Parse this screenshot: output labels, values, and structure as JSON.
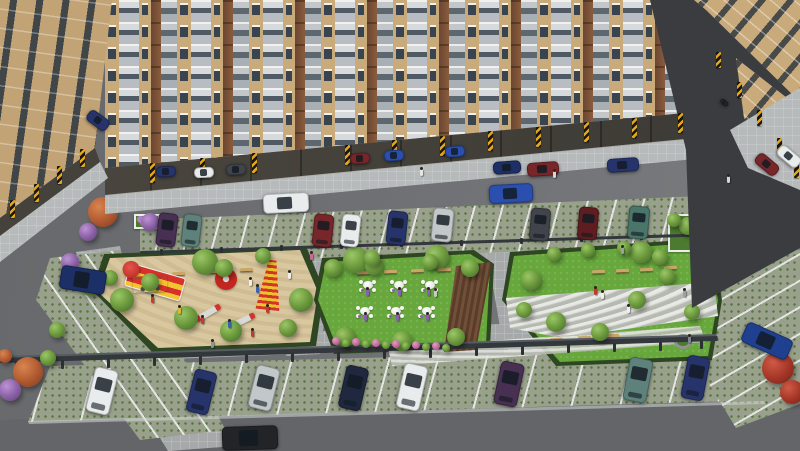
{
  "scene": {
    "description": "Aerial 3D architectural rendering of a residential apartment complex: tan mid-rise towers with balconies and stilt parking, internal road with moving cars, two rows of grass-paver parking bays, a sand playground with red-and-yellow play equipment, a central event lawn with six white table-and-chair sets, a pebble-path garden with benches, landscaped trees and flower planters.",
    "canvas": {
      "w": 800,
      "h": 451
    },
    "colors": {
      "road": "#6e7073",
      "roadBottom": "#636568",
      "shadow": "#3a3c40",
      "paver": "#a6a9aa",
      "apron": "#b7babb",
      "grassPaver": "#99a08c",
      "grassDot": "#5b7744",
      "lawn": "#67a73c",
      "sand": "#d9c79f",
      "hedge": "#2e4722",
      "line": "#e3e5e3",
      "rail": "#33383c",
      "tan": "#c8aa7b",
      "brown": "#7b5237",
      "glass": "#39444f",
      "stilt": "#45423c",
      "hazardY": "#e2a61d",
      "pebble": "#ccCfc6",
      "deck": "#5a3c28",
      "bench": "#c9a76a",
      "tableWhite": "#f4f4f2",
      "white": "#e9ecec",
      "silver": "#c2c7c9",
      "navy": "#27346b",
      "navy2": "#1c2f66",
      "blue": "#2a4faf",
      "blue2": "#1f3f8f",
      "darkblue": "#20283f",
      "darkred": "#77262a",
      "maroon": "#5f1d22",
      "purple": "#473052",
      "teal": "#5e827b",
      "tealgreen": "#49756a",
      "darkgrey": "#41454b",
      "grey": "#888d91",
      "black": "#222428"
    },
    "facade_pattern": {
      "start_x": 105,
      "repeat": 8,
      "unit": [
        {
          "t": "wall",
          "w": 14
        },
        {
          "t": "balc",
          "w": 20
        },
        {
          "t": "wall",
          "w": 12
        },
        {
          "t": "brown",
          "w": 10
        },
        {
          "t": "gbal",
          "w": 16
        }
      ],
      "tail": [
        {
          "t": "wall",
          "w": 14
        }
      ]
    },
    "cars": [
      {
        "x": 157,
        "y": 213,
        "w": 20,
        "h": 34,
        "r": 7,
        "c": "purple"
      },
      {
        "x": 182,
        "y": 214,
        "w": 19,
        "h": 33,
        "r": 7,
        "c": "teal"
      },
      {
        "x": 313,
        "y": 214,
        "w": 20,
        "h": 33,
        "r": 6,
        "c": "darkred"
      },
      {
        "x": 341,
        "y": 214,
        "w": 19,
        "h": 33,
        "r": 6,
        "c": "white"
      },
      {
        "x": 387,
        "y": 211,
        "w": 20,
        "h": 34,
        "r": 6,
        "c": "navy"
      },
      {
        "x": 432,
        "y": 208,
        "w": 21,
        "h": 34,
        "r": 6,
        "c": "silver"
      },
      {
        "x": 530,
        "y": 208,
        "w": 20,
        "h": 33,
        "r": 5,
        "c": "darkgrey"
      },
      {
        "x": 578,
        "y": 207,
        "w": 20,
        "h": 33,
        "r": 5,
        "c": "maroon"
      },
      {
        "x": 628,
        "y": 206,
        "w": 21,
        "h": 33,
        "r": 5,
        "c": "tealgreen"
      },
      {
        "x": 90,
        "y": 368,
        "w": 24,
        "h": 46,
        "r": 14,
        "c": "white"
      },
      {
        "x": 190,
        "y": 370,
        "w": 23,
        "h": 44,
        "r": 14,
        "c": "navy"
      },
      {
        "x": 252,
        "y": 366,
        "w": 24,
        "h": 44,
        "r": 14,
        "c": "silver"
      },
      {
        "x": 342,
        "y": 366,
        "w": 23,
        "h": 44,
        "r": 13,
        "c": "darkblue"
      },
      {
        "x": 400,
        "y": 364,
        "w": 24,
        "h": 46,
        "r": 13,
        "c": "white"
      },
      {
        "x": 497,
        "y": 362,
        "w": 24,
        "h": 44,
        "r": 12,
        "c": "purple"
      },
      {
        "x": 626,
        "y": 358,
        "w": 24,
        "h": 44,
        "r": 11,
        "c": "teal"
      },
      {
        "x": 684,
        "y": 356,
        "w": 23,
        "h": 44,
        "r": 11,
        "c": "navy"
      },
      {
        "x": 263,
        "y": 193,
        "w": 46,
        "h": 20,
        "r": -3,
        "c": "white"
      },
      {
        "x": 489,
        "y": 184,
        "w": 44,
        "h": 19,
        "r": -3,
        "c": "blue"
      },
      {
        "x": 527,
        "y": 162,
        "w": 32,
        "h": 14,
        "r": -4,
        "c": "darkred"
      },
      {
        "x": 607,
        "y": 158,
        "w": 32,
        "h": 14,
        "r": -4,
        "c": "navy"
      },
      {
        "x": 493,
        "y": 161,
        "w": 28,
        "h": 13,
        "r": -4,
        "c": "navy2"
      },
      {
        "x": 156,
        "y": 166,
        "w": 20,
        "h": 11,
        "r": -3,
        "c": "navy"
      },
      {
        "x": 194,
        "y": 167,
        "w": 20,
        "h": 11,
        "r": -3,
        "c": "white"
      },
      {
        "x": 226,
        "y": 164,
        "w": 20,
        "h": 11,
        "r": -3,
        "c": "darkgrey"
      },
      {
        "x": 350,
        "y": 153,
        "w": 20,
        "h": 11,
        "r": -4,
        "c": "darkred"
      },
      {
        "x": 384,
        "y": 150,
        "w": 20,
        "h": 11,
        "r": -4,
        "c": "blue"
      },
      {
        "x": 445,
        "y": 146,
        "w": 20,
        "h": 11,
        "r": -4,
        "c": "blue"
      },
      {
        "x": 754,
        "y": 158,
        "w": 26,
        "h": 13,
        "r": 40,
        "c": "darkred"
      },
      {
        "x": 776,
        "y": 150,
        "w": 26,
        "h": 13,
        "r": 40,
        "c": "white"
      },
      {
        "x": 86,
        "y": 114,
        "w": 24,
        "h": 13,
        "r": 36,
        "c": "navy"
      },
      {
        "x": 60,
        "y": 268,
        "w": 46,
        "h": 24,
        "r": 9,
        "c": "navy2"
      },
      {
        "x": 742,
        "y": 330,
        "w": 50,
        "h": 22,
        "r": 24,
        "c": "blue2"
      },
      {
        "x": 222,
        "y": 426,
        "w": 56,
        "h": 24,
        "r": -2,
        "c": "black"
      },
      {
        "x": 720,
        "y": 100,
        "w": 9,
        "h": 5,
        "r": 40,
        "c": "black"
      }
    ],
    "hazards": [
      {
        "x": 150,
        "y": 163,
        "h": 20
      },
      {
        "x": 200,
        "y": 158,
        "h": 20
      },
      {
        "x": 252,
        "y": 153,
        "h": 20
      },
      {
        "x": 345,
        "y": 145,
        "h": 20
      },
      {
        "x": 392,
        "y": 140,
        "h": 20
      },
      {
        "x": 440,
        "y": 136,
        "h": 20
      },
      {
        "x": 488,
        "y": 131,
        "h": 20
      },
      {
        "x": 536,
        "y": 127,
        "h": 20
      },
      {
        "x": 584,
        "y": 122,
        "h": 20
      },
      {
        "x": 632,
        "y": 118,
        "h": 20
      },
      {
        "x": 678,
        "y": 113,
        "h": 20
      },
      {
        "x": 10,
        "y": 200,
        "h": 18
      },
      {
        "x": 34,
        "y": 184,
        "h": 18
      },
      {
        "x": 57,
        "y": 166,
        "h": 18
      },
      {
        "x": 80,
        "y": 149,
        "h": 18
      },
      {
        "x": 716,
        "y": 52,
        "h": 16
      },
      {
        "x": 737,
        "y": 82,
        "h": 16
      },
      {
        "x": 757,
        "y": 110,
        "h": 16
      },
      {
        "x": 777,
        "y": 138,
        "h": 16
      },
      {
        "x": 794,
        "y": 162,
        "h": 16
      }
    ],
    "trees": [
      {
        "x": 205,
        "y": 262,
        "r": 13,
        "t": "g"
      },
      {
        "x": 224,
        "y": 268,
        "r": 9,
        "t": "g"
      },
      {
        "x": 356,
        "y": 260,
        "r": 13,
        "t": "g"
      },
      {
        "x": 374,
        "y": 266,
        "r": 9,
        "t": "g"
      },
      {
        "x": 437,
        "y": 257,
        "r": 12,
        "t": "g"
      },
      {
        "x": 641,
        "y": 252,
        "r": 11,
        "t": "g"
      },
      {
        "x": 660,
        "y": 257,
        "r": 8,
        "t": "g"
      },
      {
        "x": 688,
        "y": 226,
        "r": 9,
        "t": "g"
      },
      {
        "x": 706,
        "y": 232,
        "r": 8,
        "t": "g"
      },
      {
        "x": 674,
        "y": 220,
        "r": 7,
        "t": "g"
      },
      {
        "x": 712,
        "y": 222,
        "r": 15,
        "t": "r"
      },
      {
        "x": 700,
        "y": 242,
        "r": 8,
        "t": "p"
      },
      {
        "x": 122,
        "y": 300,
        "r": 12,
        "t": "g"
      },
      {
        "x": 150,
        "y": 282,
        "r": 9,
        "t": "g"
      },
      {
        "x": 186,
        "y": 318,
        "r": 12,
        "t": "g"
      },
      {
        "x": 231,
        "y": 331,
        "r": 11,
        "t": "g"
      },
      {
        "x": 301,
        "y": 300,
        "r": 12,
        "t": "g"
      },
      {
        "x": 288,
        "y": 328,
        "r": 9,
        "t": "g"
      },
      {
        "x": 263,
        "y": 256,
        "r": 8,
        "t": "g"
      },
      {
        "x": 110,
        "y": 278,
        "r": 8,
        "t": "g"
      },
      {
        "x": 333,
        "y": 268,
        "r": 9,
        "t": "g"
      },
      {
        "x": 345,
        "y": 337,
        "r": 10,
        "t": "g"
      },
      {
        "x": 402,
        "y": 341,
        "r": 10,
        "t": "g"
      },
      {
        "x": 456,
        "y": 337,
        "r": 9,
        "t": "g"
      },
      {
        "x": 470,
        "y": 268,
        "r": 9,
        "t": "g"
      },
      {
        "x": 430,
        "y": 262,
        "r": 8,
        "t": "g"
      },
      {
        "x": 372,
        "y": 258,
        "r": 8,
        "t": "g"
      },
      {
        "x": 336,
        "y": 341,
        "r": 4,
        "t": "pk"
      },
      {
        "x": 346,
        "y": 343,
        "r": 4,
        "t": "g"
      },
      {
        "x": 356,
        "y": 342,
        "r": 4,
        "t": "pk"
      },
      {
        "x": 366,
        "y": 344,
        "r": 4,
        "t": "g"
      },
      {
        "x": 376,
        "y": 343,
        "r": 4,
        "t": "pk"
      },
      {
        "x": 386,
        "y": 345,
        "r": 4,
        "t": "g"
      },
      {
        "x": 396,
        "y": 344,
        "r": 4,
        "t": "pk"
      },
      {
        "x": 406,
        "y": 346,
        "r": 4,
        "t": "g"
      },
      {
        "x": 416,
        "y": 345,
        "r": 4,
        "t": "pk"
      },
      {
        "x": 426,
        "y": 347,
        "r": 4,
        "t": "g"
      },
      {
        "x": 436,
        "y": 346,
        "r": 4,
        "t": "pk"
      },
      {
        "x": 446,
        "y": 348,
        "r": 4,
        "t": "g"
      },
      {
        "x": 531,
        "y": 280,
        "r": 10,
        "t": "g"
      },
      {
        "x": 524,
        "y": 310,
        "r": 8,
        "t": "g"
      },
      {
        "x": 556,
        "y": 322,
        "r": 10,
        "t": "g"
      },
      {
        "x": 600,
        "y": 332,
        "r": 9,
        "t": "g"
      },
      {
        "x": 637,
        "y": 300,
        "r": 9,
        "t": "g"
      },
      {
        "x": 667,
        "y": 276,
        "r": 8,
        "t": "g"
      },
      {
        "x": 692,
        "y": 312,
        "r": 8,
        "t": "g"
      },
      {
        "x": 710,
        "y": 288,
        "r": 8,
        "t": "g"
      },
      {
        "x": 588,
        "y": 250,
        "r": 7,
        "t": "g"
      },
      {
        "x": 624,
        "y": 248,
        "r": 7,
        "t": "g"
      },
      {
        "x": 554,
        "y": 254,
        "r": 7,
        "t": "g"
      },
      {
        "x": 103,
        "y": 212,
        "r": 15,
        "t": "o"
      },
      {
        "x": 88,
        "y": 232,
        "r": 9,
        "t": "p"
      },
      {
        "x": 150,
        "y": 222,
        "r": 9,
        "t": "p"
      },
      {
        "x": 70,
        "y": 262,
        "r": 9,
        "t": "p"
      },
      {
        "x": 90,
        "y": 287,
        "r": 9,
        "t": "g"
      },
      {
        "x": 57,
        "y": 330,
        "r": 8,
        "t": "g"
      },
      {
        "x": 28,
        "y": 372,
        "r": 15,
        "t": "o"
      },
      {
        "x": 10,
        "y": 390,
        "r": 11,
        "t": "p"
      },
      {
        "x": 48,
        "y": 358,
        "r": 8,
        "t": "g"
      },
      {
        "x": 5,
        "y": 356,
        "r": 7,
        "t": "o"
      },
      {
        "x": 778,
        "y": 368,
        "r": 16,
        "t": "r"
      },
      {
        "x": 792,
        "y": 392,
        "r": 12,
        "t": "r"
      }
    ],
    "people": [
      {
        "x": 420,
        "y": 169,
        "c": "#e6e6e3"
      },
      {
        "x": 553,
        "y": 171,
        "c": "#d9d6d0"
      },
      {
        "x": 310,
        "y": 253,
        "c": "#c76a95"
      },
      {
        "x": 249,
        "y": 279,
        "c": "#f0f0ee"
      },
      {
        "x": 256,
        "y": 286,
        "c": "#3a62b0"
      },
      {
        "x": 151,
        "y": 296,
        "c": "#c23b2e"
      },
      {
        "x": 178,
        "y": 307,
        "c": "#d8b83a"
      },
      {
        "x": 201,
        "y": 317,
        "c": "#c23b2e"
      },
      {
        "x": 228,
        "y": 321,
        "c": "#3a62b0"
      },
      {
        "x": 251,
        "y": 330,
        "c": "#c23b2e"
      },
      {
        "x": 266,
        "y": 306,
        "c": "#c23b2e"
      },
      {
        "x": 288,
        "y": 272,
        "c": "#f0f0ee"
      },
      {
        "x": 211,
        "y": 341,
        "c": "#8e959b"
      },
      {
        "x": 594,
        "y": 288,
        "c": "#c0392b"
      },
      {
        "x": 601,
        "y": 292,
        "c": "#f0f0ee"
      },
      {
        "x": 627,
        "y": 306,
        "c": "#eef0f0"
      },
      {
        "x": 683,
        "y": 290,
        "c": "#9aa2a8"
      },
      {
        "x": 621,
        "y": 247,
        "c": "#9aa2a8"
      },
      {
        "x": 688,
        "y": 336,
        "c": "#7f8890"
      },
      {
        "x": 434,
        "y": 290,
        "c": "#c9c9c9"
      },
      {
        "x": 366,
        "y": 289,
        "c": "#8a5fb0"
      },
      {
        "x": 398,
        "y": 289,
        "c": "#8a5fb0"
      },
      {
        "x": 427,
        "y": 289,
        "c": "#8a5fb0"
      },
      {
        "x": 364,
        "y": 314,
        "c": "#8a5fb0"
      },
      {
        "x": 396,
        "y": 314,
        "c": "#8a5fb0"
      },
      {
        "x": 426,
        "y": 314,
        "c": "#8a5fb0"
      },
      {
        "x": 727,
        "y": 176,
        "c": "#d9d6d0"
      }
    ],
    "tables": [
      {
        "x": 359,
        "y": 278
      },
      {
        "x": 390,
        "y": 278
      },
      {
        "x": 421,
        "y": 278
      },
      {
        "x": 356,
        "y": 304
      },
      {
        "x": 387,
        "y": 304
      },
      {
        "x": 418,
        "y": 304
      }
    ],
    "benches": [
      {
        "x": 357,
        "y": 271
      },
      {
        "x": 384,
        "y": 270
      },
      {
        "x": 411,
        "y": 269
      },
      {
        "x": 438,
        "y": 268
      },
      {
        "x": 172,
        "y": 272
      },
      {
        "x": 206,
        "y": 270
      },
      {
        "x": 240,
        "y": 268
      },
      {
        "x": 592,
        "y": 270
      },
      {
        "x": 616,
        "y": 269
      },
      {
        "x": 640,
        "y": 268
      },
      {
        "x": 664,
        "y": 266
      },
      {
        "x": 550,
        "y": 338
      },
      {
        "x": 578,
        "y": 336
      },
      {
        "x": 606,
        "y": 334
      }
    ],
    "planters": [
      {
        "x": 296,
        "y": 149,
        "w": 34,
        "h": 30,
        "t": "purple"
      },
      {
        "x": 56,
        "y": 152,
        "w": 30,
        "h": 20,
        "t": "purple"
      },
      {
        "x": 134,
        "y": 214,
        "w": 26,
        "h": 15,
        "t": "purple"
      },
      {
        "x": 744,
        "y": 147,
        "w": 48,
        "h": 24,
        "t": "hedge"
      },
      {
        "x": 668,
        "y": 214,
        "w": 64,
        "h": 38,
        "t": "hedge"
      }
    ],
    "posts": [
      {
        "x": 15,
        "y": 361,
        "h": 9
      },
      {
        "x": 61,
        "y": 360,
        "h": 9
      },
      {
        "x": 107,
        "y": 359,
        "h": 9
      },
      {
        "x": 153,
        "y": 357,
        "h": 9
      },
      {
        "x": 199,
        "y": 356,
        "h": 9
      },
      {
        "x": 245,
        "y": 354,
        "h": 9
      },
      {
        "x": 291,
        "y": 353,
        "h": 9
      },
      {
        "x": 337,
        "y": 352,
        "h": 9
      },
      {
        "x": 383,
        "y": 350,
        "h": 9
      },
      {
        "x": 429,
        "y": 349,
        "h": 9
      },
      {
        "x": 475,
        "y": 347,
        "h": 9
      },
      {
        "x": 521,
        "y": 346,
        "h": 9
      },
      {
        "x": 567,
        "y": 344,
        "h": 9
      },
      {
        "x": 613,
        "y": 343,
        "h": 9
      },
      {
        "x": 659,
        "y": 342,
        "h": 9
      },
      {
        "x": 700,
        "y": 340,
        "h": 9
      },
      {
        "x": 160,
        "y": 249,
        "h": 6
      },
      {
        "x": 220,
        "y": 247,
        "h": 6
      },
      {
        "x": 280,
        "y": 245,
        "h": 6
      },
      {
        "x": 340,
        "y": 243,
        "h": 6
      },
      {
        "x": 400,
        "y": 241,
        "h": 6
      },
      {
        "x": 460,
        "y": 240,
        "h": 6
      },
      {
        "x": 520,
        "y": 238,
        "h": 6
      },
      {
        "x": 580,
        "y": 236,
        "h": 6
      },
      {
        "x": 640,
        "y": 234,
        "h": 6
      }
    ],
    "equipment": [
      {
        "type": "slide",
        "x": 126,
        "y": 270,
        "w": 58,
        "h": 24,
        "rot": 16
      },
      {
        "type": "swing",
        "x": 133,
        "y": 276,
        "w": 34,
        "h": 16,
        "rot": -3
      },
      {
        "type": "climber",
        "x": 258,
        "y": 260,
        "w": 24,
        "h": 50,
        "rot": 6
      },
      {
        "type": "merry",
        "x": 226,
        "y": 279,
        "r": 11
      },
      {
        "type": "seesaw",
        "x": 194,
        "y": 310,
        "w": 28,
        "h": 6,
        "rot": -30
      },
      {
        "type": "seesaw",
        "x": 228,
        "y": 318,
        "w": 28,
        "h": 6,
        "rot": -26
      }
    ]
  }
}
